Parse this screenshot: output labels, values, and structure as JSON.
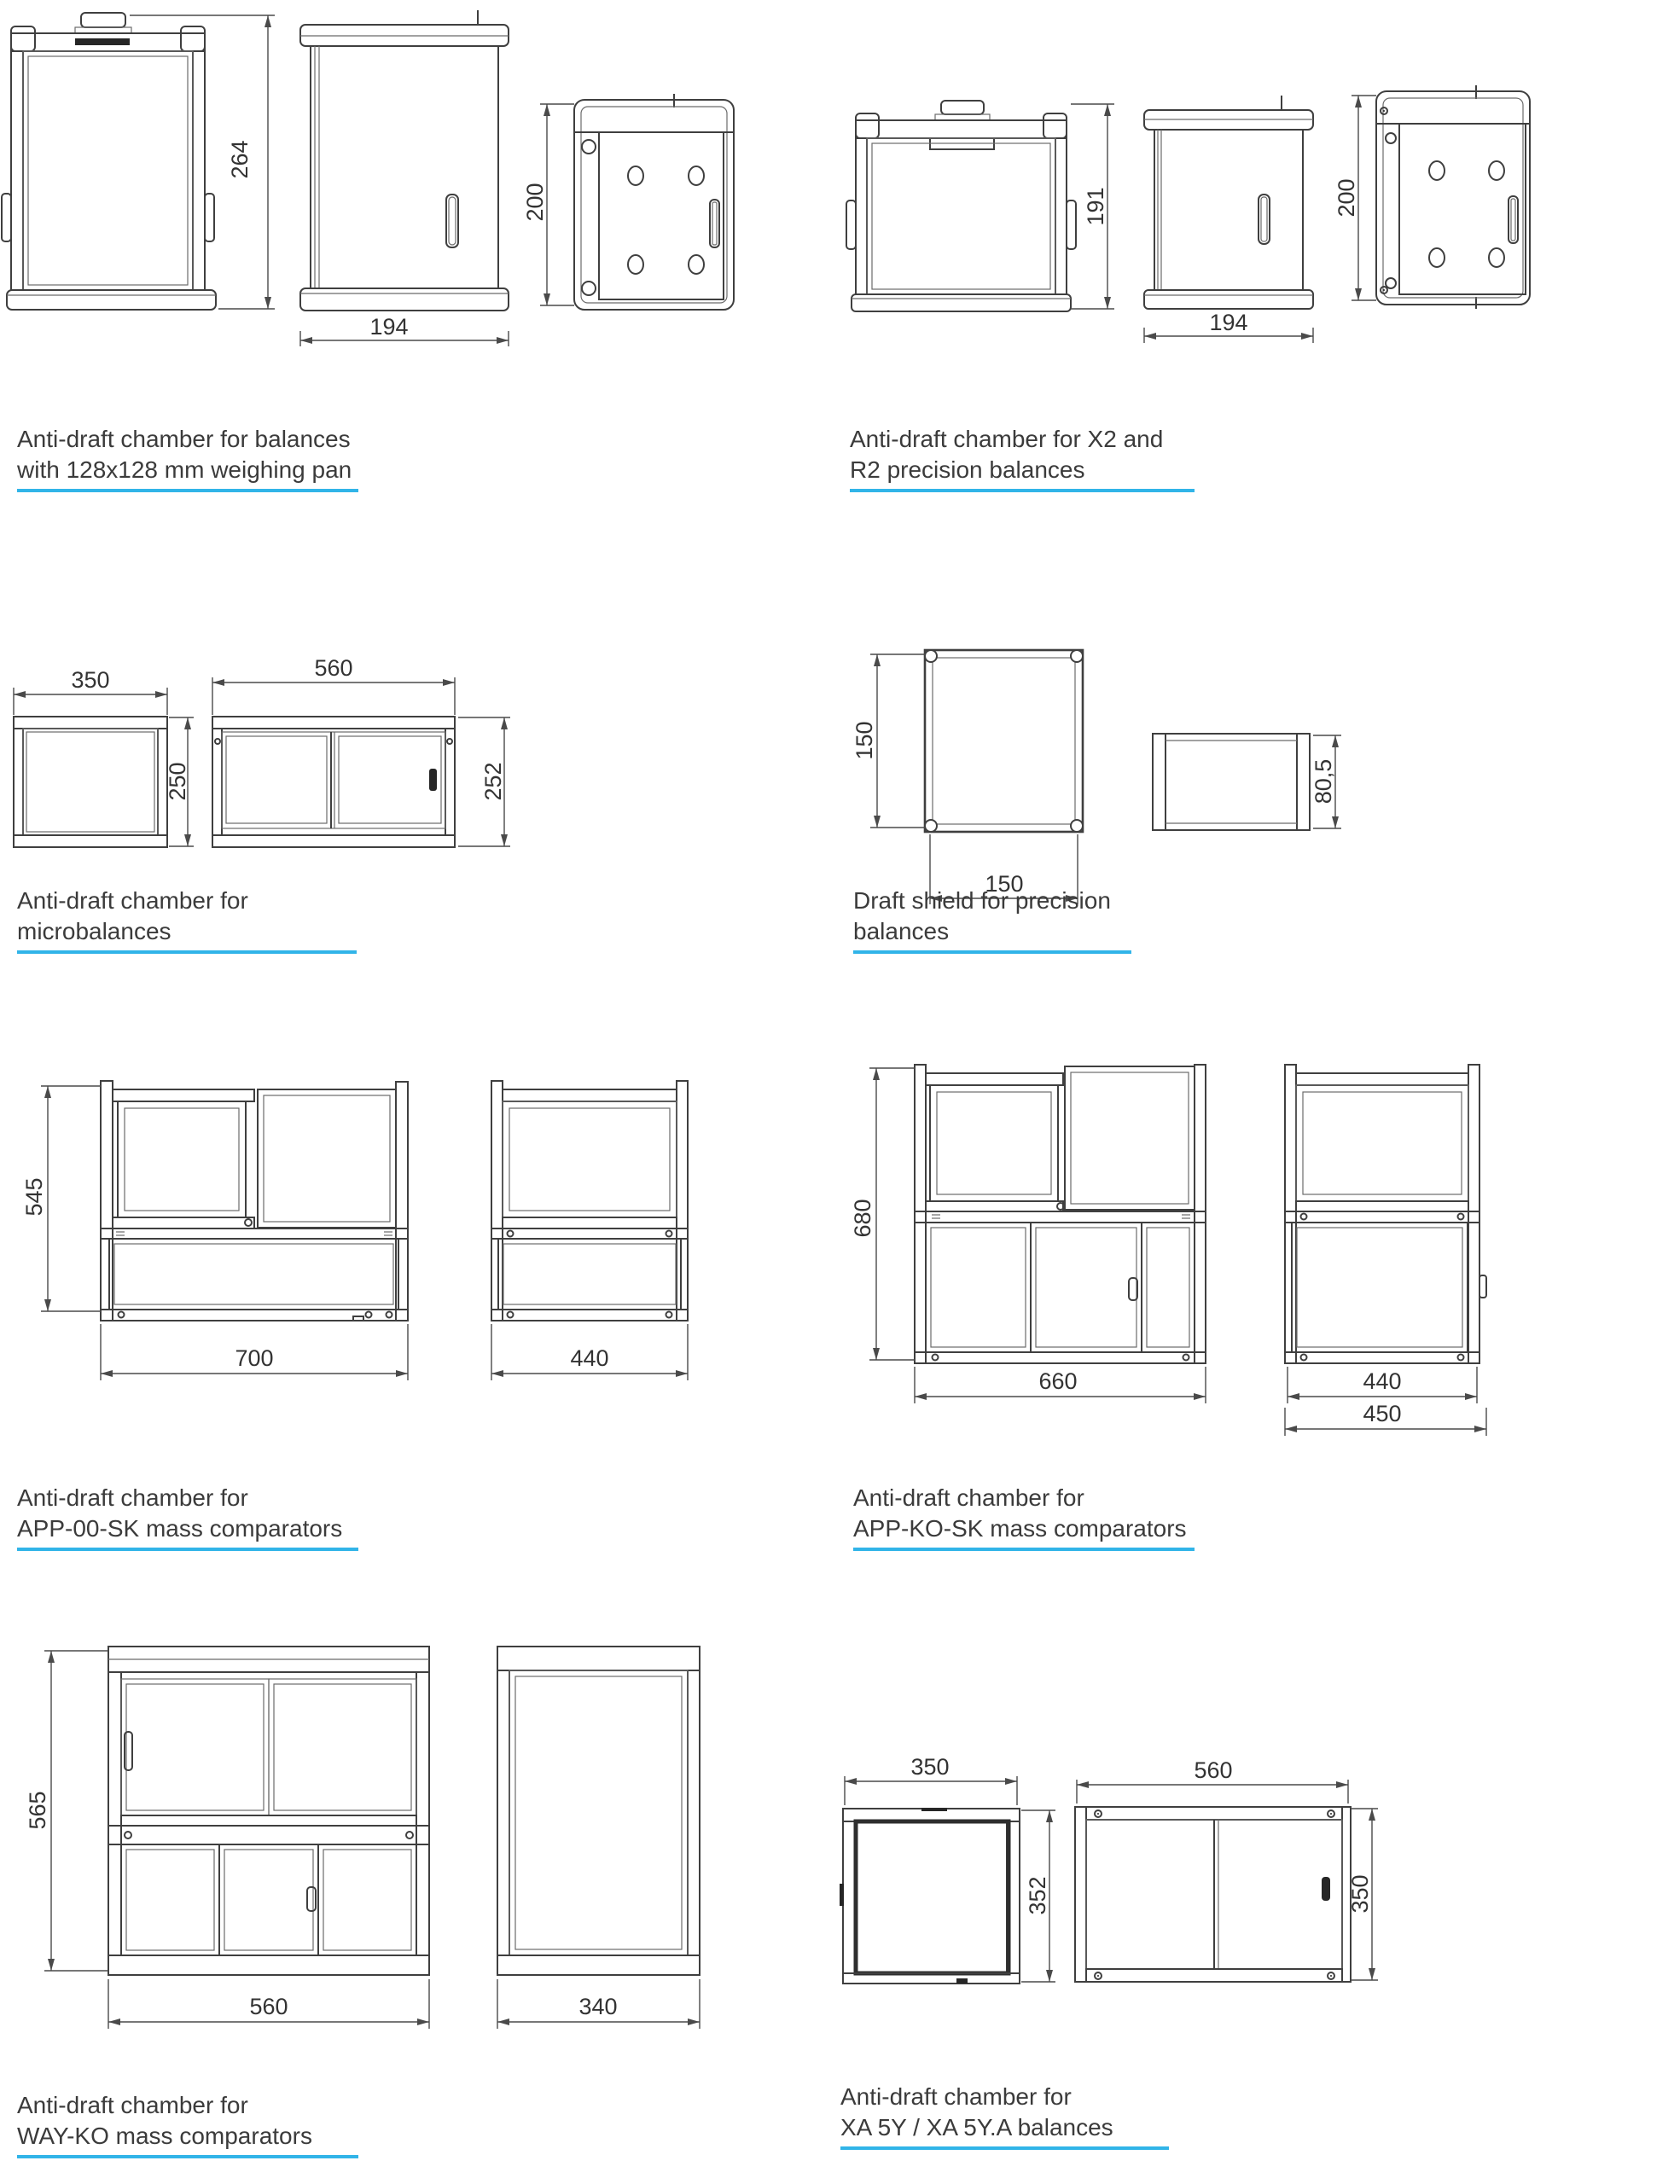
{
  "page": {
    "background": "#ffffff",
    "accent_color": "#31b4e8",
    "line_color": "#3f3f3f",
    "label_color": "#333333"
  },
  "sections": [
    {
      "id": "pan128",
      "caption": [
        "Anti-draft chamber for balances",
        "with 128x128 mm weighing pan"
      ],
      "dims": {
        "height": "264",
        "width": "194",
        "depth": "200"
      }
    },
    {
      "id": "x2r2",
      "caption": [
        "Anti-draft chamber for X2 and",
        "R2 precision balances"
      ],
      "dims": {
        "height": "191",
        "width": "194",
        "depth": "200"
      }
    },
    {
      "id": "micro",
      "caption": [
        "Anti-draft chamber for",
        "microbalances"
      ],
      "dims": {
        "front_width": "350",
        "front_height": "250",
        "side_width": "560",
        "side_height": "252"
      }
    },
    {
      "id": "shield",
      "caption": [
        "Draft shield for precision",
        "balances"
      ],
      "dims": {
        "width": "150",
        "depth": "150",
        "height": "80,5"
      }
    },
    {
      "id": "app00sk",
      "caption": [
        "Anti-draft chamber for",
        "APP-00-SK mass comparators"
      ],
      "dims": {
        "height": "545",
        "width": "700",
        "depth": "440"
      }
    },
    {
      "id": "appkosk",
      "caption": [
        "Anti-draft chamber for",
        "APP-KO-SK mass comparators"
      ],
      "dims": {
        "height": "680",
        "width": "660",
        "depth": "440",
        "outer_depth": "450"
      }
    },
    {
      "id": "wayko",
      "caption": [
        "Anti-draft chamber for",
        "WAY-KO mass comparators"
      ],
      "dims": {
        "height": "565",
        "width": "560",
        "depth": "340"
      }
    },
    {
      "id": "xa5y",
      "caption": [
        "Anti-draft chamber for",
        "XA 5Y / XA 5Y.A balances"
      ],
      "dims": {
        "front_width": "350",
        "front_height": "352",
        "side_width": "560",
        "side_height": "350"
      }
    }
  ]
}
